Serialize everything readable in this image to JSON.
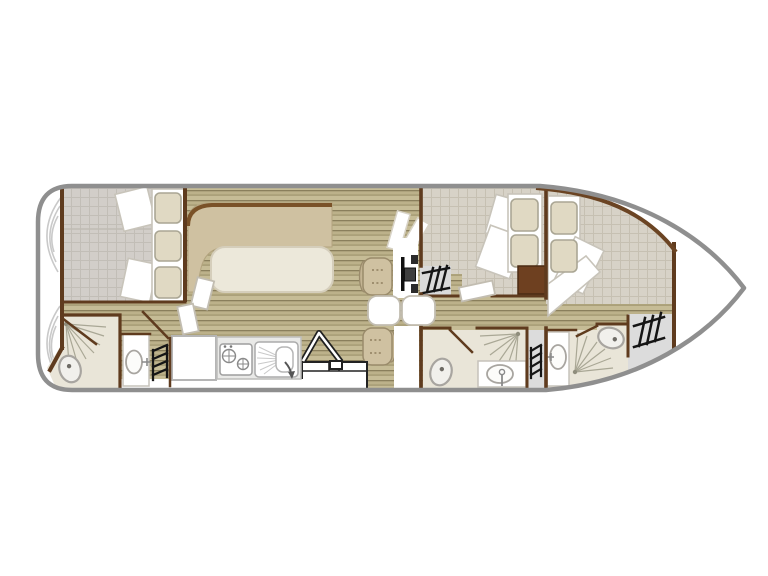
{
  "plan": {
    "type": "boat-floor-plan",
    "orientation": "bow-right",
    "rooms": [
      {
        "id": "stern-deck",
        "fixtures": [
          "deck-arc-decoration"
        ]
      },
      {
        "id": "aft-cabin",
        "fixtures": [
          "bed-mattress",
          "pillow",
          "pillow",
          "pillow"
        ]
      },
      {
        "id": "aft-bathroom",
        "fixtures": [
          "shower",
          "toilet",
          "washbasin",
          "ladder-steps"
        ]
      },
      {
        "id": "galley",
        "fixtures": [
          "fridge",
          "stove-two-burner",
          "kitchen-sink",
          "folding-steps"
        ]
      },
      {
        "id": "saloon",
        "fixtures": [
          "l-bench",
          "table",
          "helm-seat",
          "steering-wheel",
          "companionway-steps",
          "dinette-seat",
          "dinette-table",
          "sliding-door",
          "sliding-door"
        ]
      },
      {
        "id": "mid-cabin",
        "fixtures": [
          "bed-mattress",
          "pillow",
          "pillow",
          "wardrobe"
        ]
      },
      {
        "id": "mid-bathroom",
        "fixtures": [
          "toilet",
          "shower",
          "washbasin"
        ]
      },
      {
        "id": "stair-niche",
        "fixtures": [
          "ladder-steps"
        ]
      },
      {
        "id": "bow-cabin",
        "fixtures": [
          "bed-mattress",
          "pillow",
          "pillow"
        ]
      },
      {
        "id": "bow-bathroom",
        "fixtures": [
          "washbasin",
          "shower",
          "toilet"
        ]
      },
      {
        "id": "bow-deck",
        "fixtures": [
          "ladder-steps"
        ]
      }
    ]
  },
  "colors": {
    "background": "#ffffff",
    "hull_outline": "#8f8f8f",
    "inner_hull": "#6b4423",
    "wall": "#5f3b1e",
    "wood_base": "#b9ae88",
    "wood_line": "#8a7f5c",
    "tile_gray": "#d2cec9",
    "tile_warm": "#d7d2c7",
    "upholstery": "#cfc1a1",
    "upholstery_edge": "#9a8b6b",
    "bench_trim": "#7a5228",
    "table_fill": "#ece8da",
    "mattress": "#ffffff",
    "mattress_edge": "#c8c4ba",
    "pillow": "#e0d9c3",
    "pillow_edge": "#aaa694",
    "bathroom_floor": "#e9e5d8",
    "fixture_fill": "#f1f0ec",
    "fixture_edge": "#a8a5a0",
    "shower_line": "#a9a795",
    "counter": "#e9e9e7",
    "hatch": "#151515",
    "deck_gray": "#dcdcdc",
    "wardrobe": "#6e4020",
    "door_leaf_edge": "#c2bdb1",
    "stern_arc": "#c9c9c9",
    "outline_dark": "#222222"
  }
}
